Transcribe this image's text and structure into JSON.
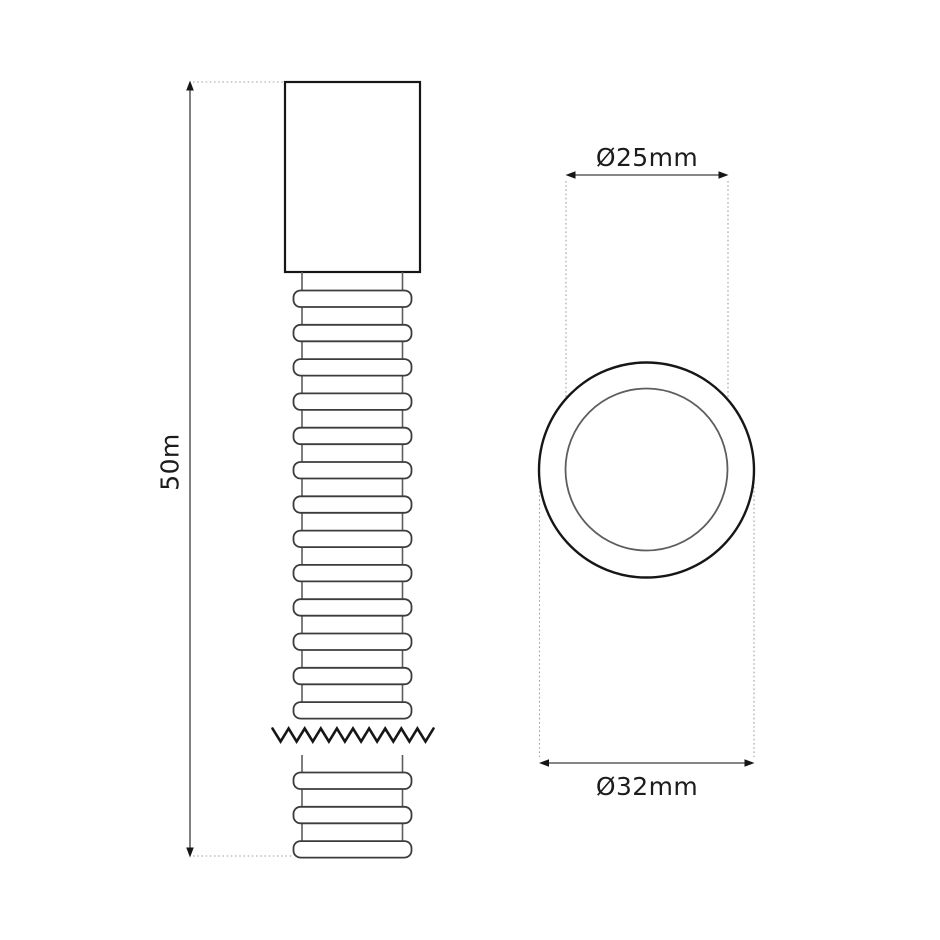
{
  "drawing": {
    "side_view": {
      "length_label": "50m"
    },
    "cross_section": {
      "inner_diameter_label": "Ø25mm",
      "outer_diameter_label": "Ø32mm"
    },
    "colors": {
      "background": "#ffffff",
      "outline_dark": "#161616",
      "outline_medium": "#3c3c3c",
      "tube_wall": "#5d5d5d",
      "dimension_line": "#3d3d3d",
      "extension_dotted": "#a0a0a0",
      "label_text": "#1c1c1c"
    }
  }
}
